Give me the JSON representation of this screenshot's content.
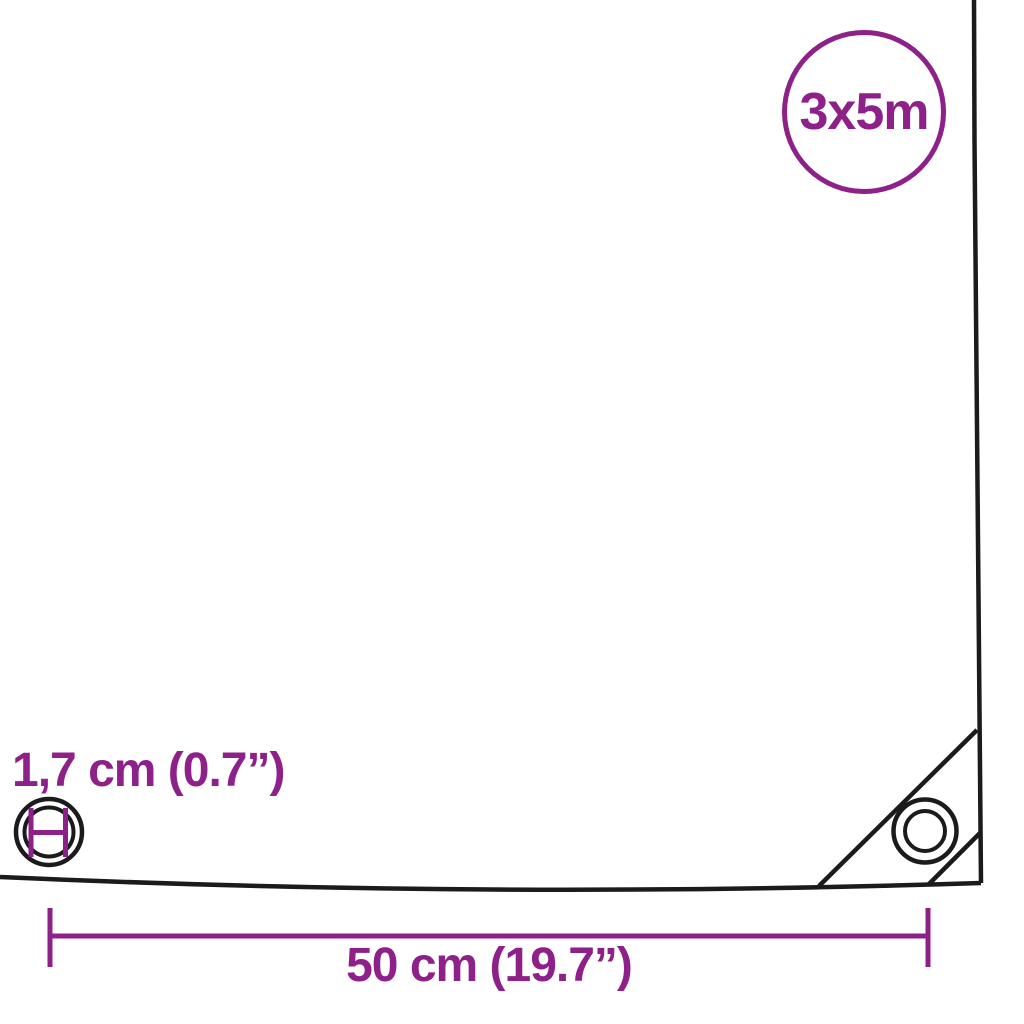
{
  "diagram": {
    "size_badge": {
      "label": "3x5m"
    },
    "eyelet_diameter": {
      "label": "1,7 cm (0.7”)"
    },
    "grommet_spacing": {
      "label": "50 cm (19.7”)"
    }
  },
  "colors": {
    "accent_purple": "#8D2089",
    "outline_black": "#1B1B1B",
    "background": "#FFFFFF"
  },
  "icons": {
    "size_badge_circle": "circle-badge",
    "left_eyelet": "eyelet-grommet-icon",
    "eyelet_diameter_marker": "inner-diameter-marker",
    "corner_grommet": "grommet-icon",
    "corner_patch": "corner-reinforcement-seams",
    "width_dimension": "dimension-line-with-end-ticks"
  }
}
